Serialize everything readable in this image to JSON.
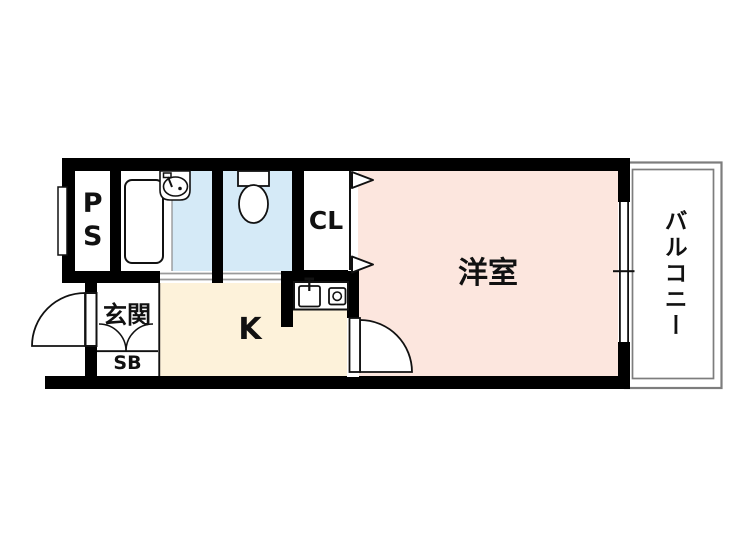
{
  "plan_title": "apartment-floor-plan",
  "rooms": {
    "ps": {
      "label": "PS"
    },
    "closet": {
      "label": "CL"
    },
    "western_room": {
      "label": "洋室"
    },
    "kitchen": {
      "label": "K"
    },
    "entrance": {
      "label": "玄関"
    },
    "shoe_box": {
      "label": "SB"
    },
    "balcony": {
      "label": "バルコニー"
    },
    "bath": {
      "fixtures": [
        "bathtub-icon",
        "sink-icon"
      ]
    },
    "toilet": {
      "fixtures": [
        "toilet-icon"
      ]
    },
    "kitchen_fixtures": [
      "kitchen-sink-icon",
      "stove-burner-icon"
    ]
  },
  "colors": {
    "wall": "#000000",
    "western_room_floor": "#fce6de",
    "wet_area_floor": "#d5eaf7",
    "kitchen_floor": "#fdf2da",
    "white_floor": "#ffffff",
    "balcony_outline": "#7d7d7d",
    "threshold_line": "#9a9a9a",
    "fixture_outline": "#111111",
    "background": "#ffffff"
  }
}
